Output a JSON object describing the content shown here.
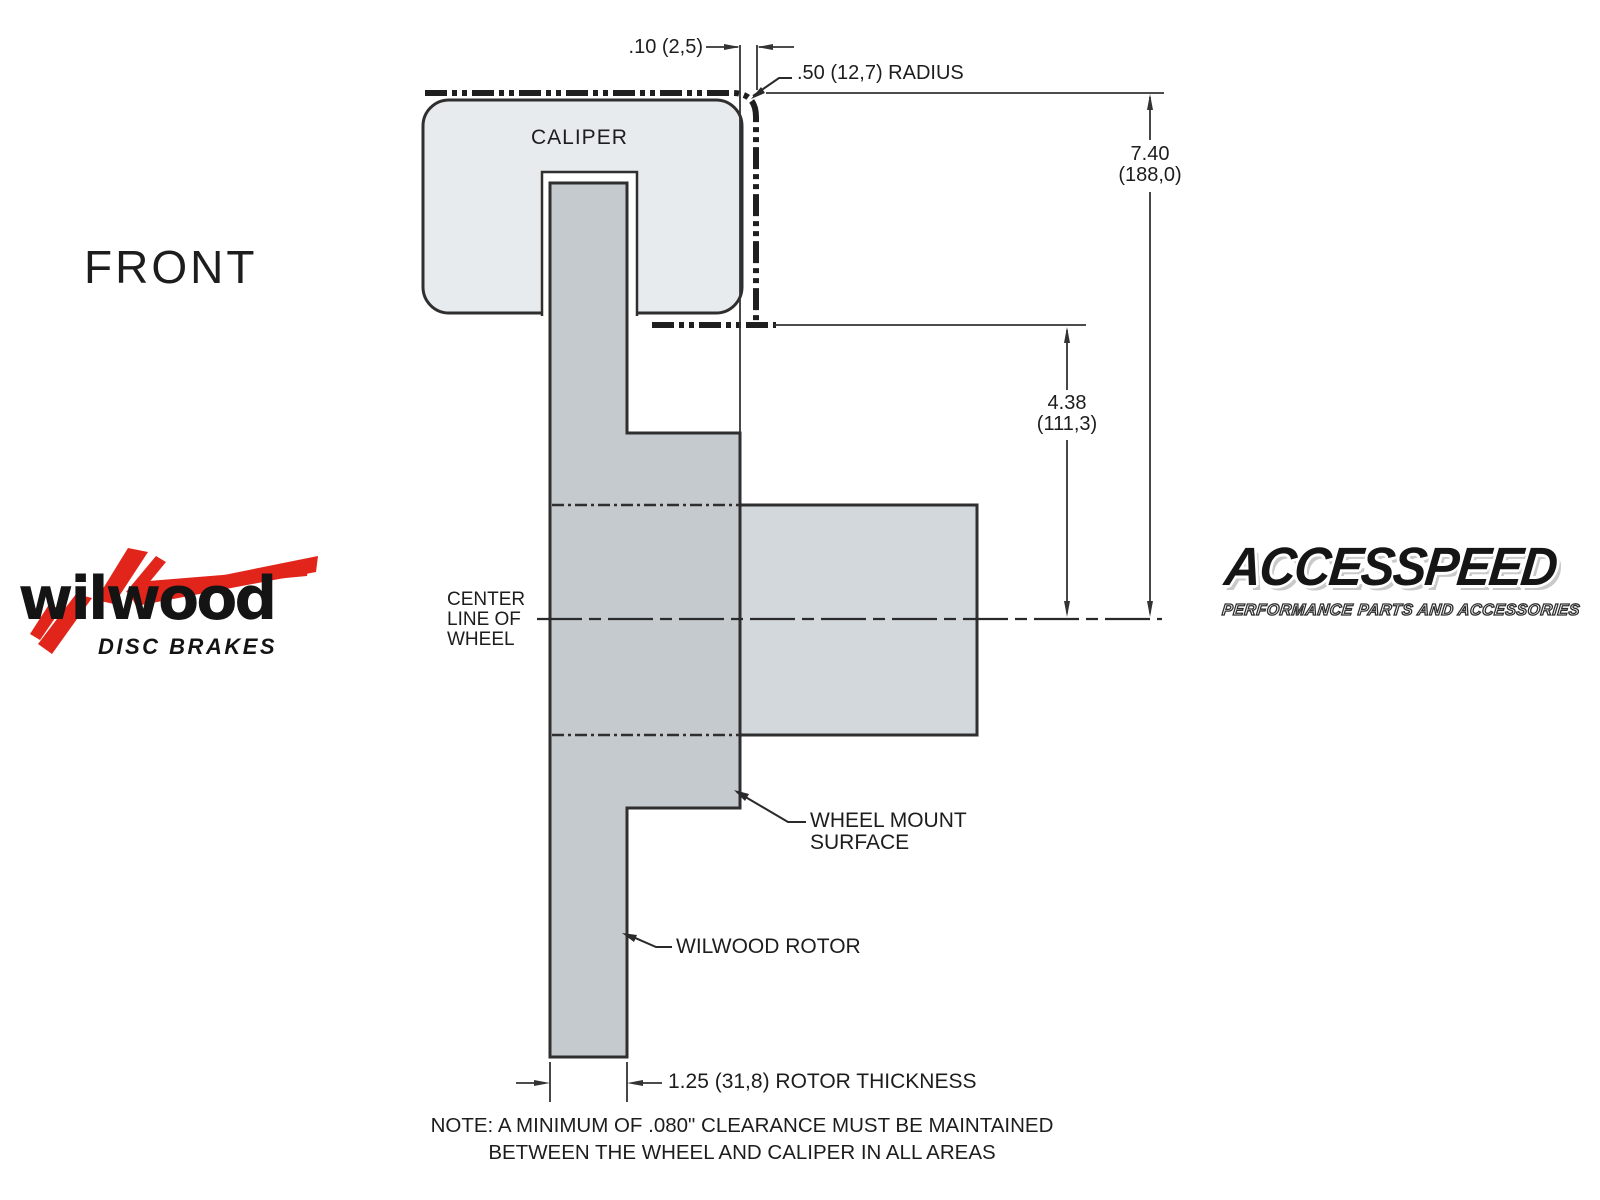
{
  "labels": {
    "front": "FRONT",
    "caliper": "CALIPER",
    "center_line": [
      "CENTER",
      "LINE OF",
      "WHEEL"
    ],
    "wheel_mount": [
      "WHEEL MOUNT",
      "SURFACE"
    ],
    "wilwood_rotor": "WILWOOD ROTOR",
    "note_line1": "NOTE: A MINIMUM OF .080\" CLEARANCE MUST BE MAINTAINED",
    "note_line2": "BETWEEN THE WHEEL AND CALIPER IN ALL AREAS"
  },
  "dimensions": {
    "caliper_wheel_gap": ".10 (2,5)",
    "corner_radius": ".50 (12,7) RADIUS",
    "overall_height_in": "7.40",
    "overall_height_mm": "(188,0)",
    "mount_height_in": "4.38",
    "mount_height_mm": "(111,3)",
    "rotor_thickness": "1.25 (31,8) ROTOR THICKNESS"
  },
  "logos": {
    "wilwood": {
      "name": "wilwood",
      "tagline": "DISC BRAKES"
    },
    "accesspeed": {
      "name": "ACCESSPEED",
      "tagline": "PERFORMANCE PARTS AND ACCESSORIES"
    }
  },
  "colors": {
    "background": "#ffffff",
    "caliper_fill": "#e8ebee",
    "rotor_fill": "#c5cacf",
    "hub_fill": "#d3d8dc",
    "line": "#2f2f2f",
    "wilwood_red": "#e2251b",
    "logo_black": "#141414"
  }
}
